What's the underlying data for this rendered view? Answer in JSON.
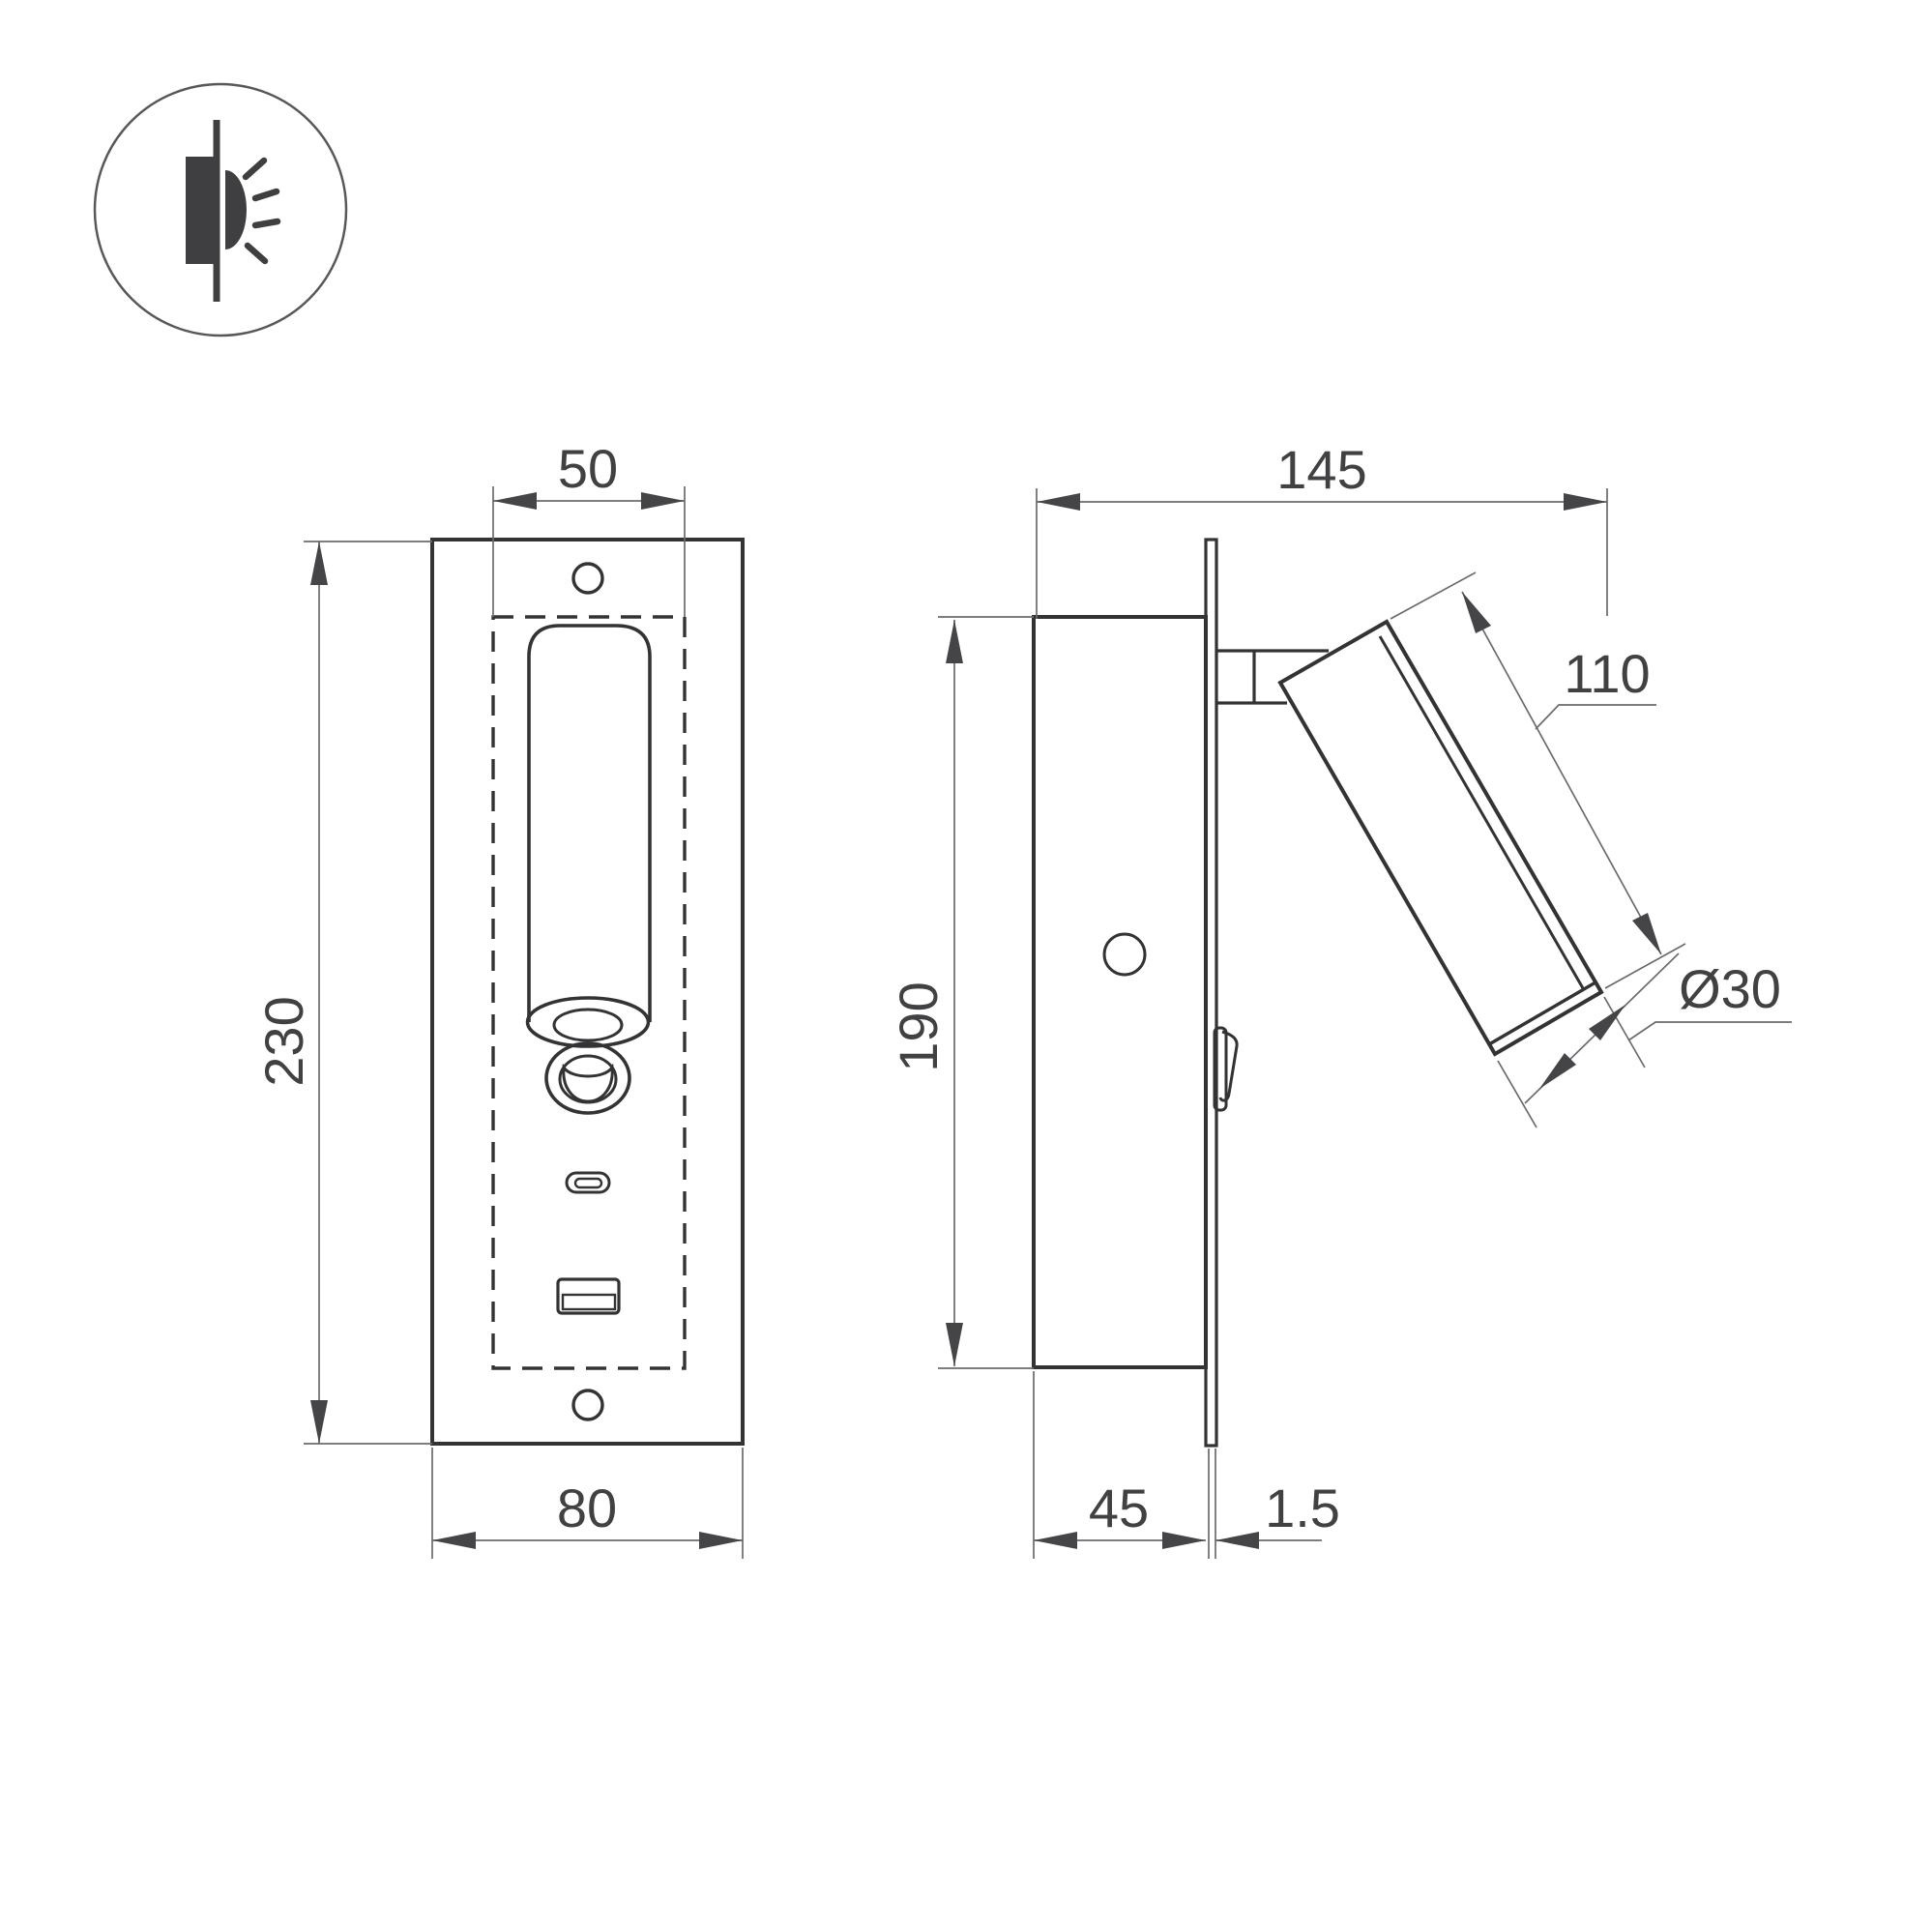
{
  "drawing": {
    "title": "recessed-bedside-reading-lamp-dimension-drawing",
    "front_view": {
      "width_top": "50",
      "height": "230",
      "width_bottom": "80"
    },
    "side_view": {
      "depth_total": "145",
      "height": "190",
      "head_length": "110",
      "head_diameter": "Ø30",
      "box_depth": "45",
      "plate_thickness": "1.5"
    },
    "colors": {
      "object_line": "#333335",
      "dimension_line": "#6b6b6d",
      "text": "#414143",
      "background": "#ffffff"
    }
  }
}
